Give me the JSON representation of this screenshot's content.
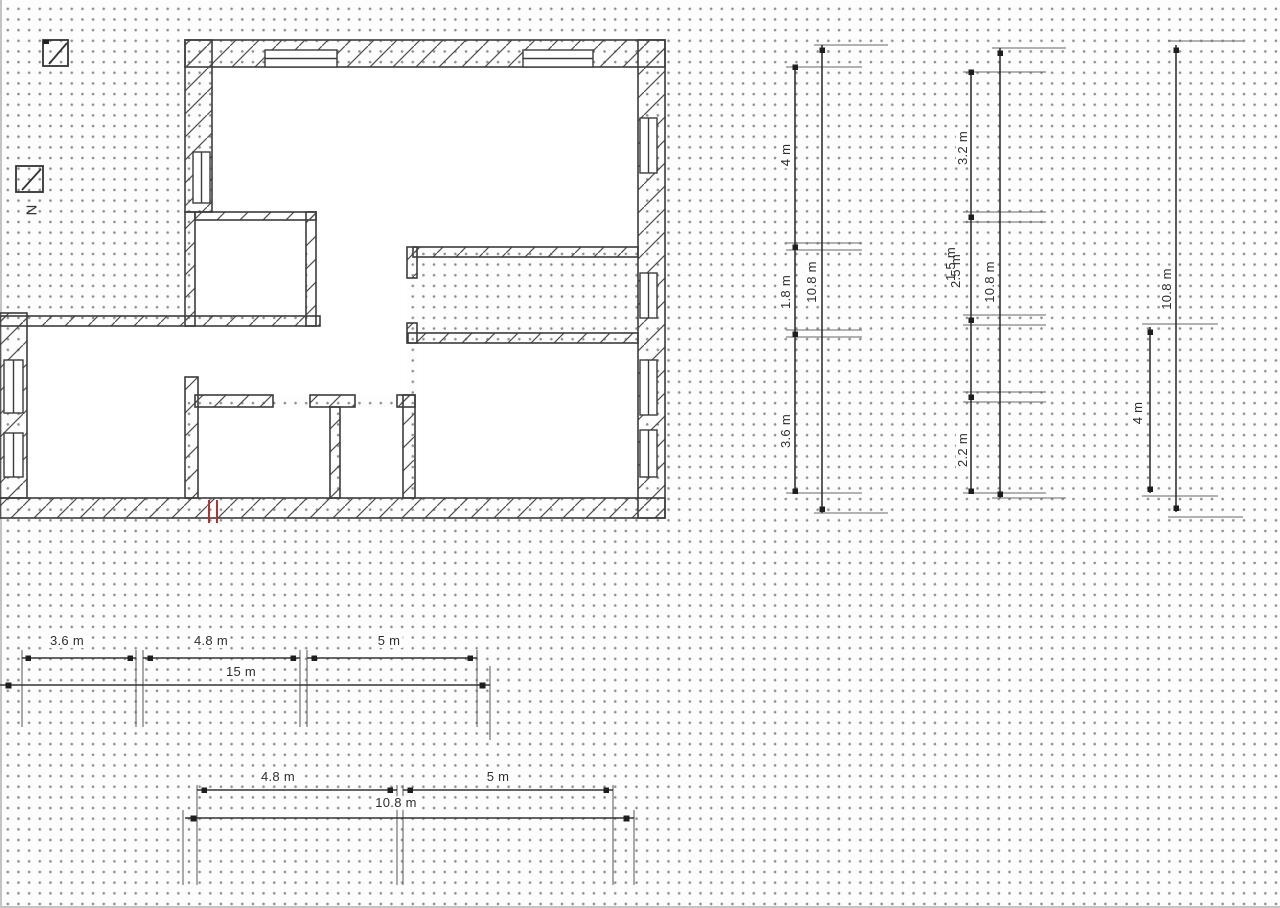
{
  "app": {
    "view": "floor-plan-drawing-canvas"
  },
  "north_symbol": {
    "label": "N"
  },
  "dims": {
    "v1": {
      "segs": [
        "4 m",
        "1.8 m",
        "3.6 m"
      ],
      "total": "10.8 m"
    },
    "v2": {
      "segs": [
        "3.2 m",
        "2.5 m",
        "1.5 m",
        "2.2 m"
      ],
      "total": "10.8 m"
    },
    "v3": {
      "segs": [
        "4 m"
      ],
      "total": "10.8 m"
    },
    "h1": {
      "segs": [
        "3.6 m",
        "4.8 m",
        "5 m"
      ],
      "total": "15 m"
    },
    "h2": {
      "segs": [
        "4.8 m",
        "5 m"
      ],
      "total": "10.8 m"
    }
  },
  "colors": {
    "wall_line": "#3c3c3c",
    "hatch_line": "#4d4d4d",
    "dimension_line": "#333333",
    "dimension_text": "#2e2e2e",
    "selection_red": "#b13434",
    "grid_dot": "#8f8f8f",
    "floor_fill": "#ffffff"
  }
}
